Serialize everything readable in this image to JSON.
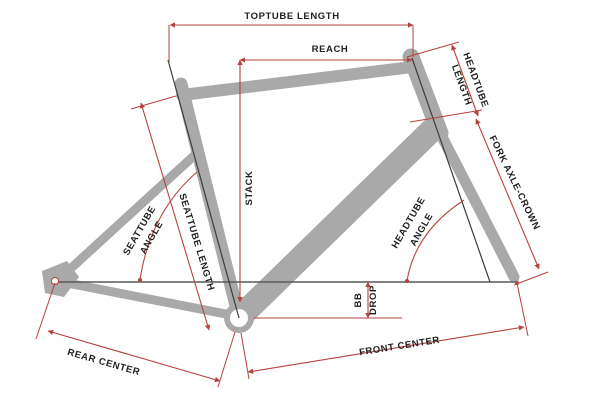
{
  "diagram": {
    "subject": "bicycle frame geometry diagram",
    "colors": {
      "frame_gray": "#a9a9a9",
      "dimension_red": "#b6423c",
      "axis_dark": "#3c3c3c",
      "axle_line_gray": "#5a5a5a",
      "label_text": "#1f1f1f",
      "background": "#ffffff"
    },
    "labels": {
      "toptube_length": "TOPTUBE LENGTH",
      "reach": "REACH",
      "stack": "STACK",
      "headtube_length_1": "HEADTUBE",
      "headtube_length_2": "LENGTH",
      "fork_axle_crown": "FORK AXLE-CROWN",
      "seattube_angle_1": "SEATTUBE",
      "seattube_angle_2": "ANGLE",
      "seattube_length": "SEATTUBE LENGTH",
      "headtube_angle_1": "HEADTUBE",
      "headtube_angle_2": "ANGLE",
      "bb_drop_1": "BB",
      "bb_drop_2": "DROP",
      "rear_center": "REAR CENTER",
      "front_center": "FRONT CENTER"
    }
  }
}
